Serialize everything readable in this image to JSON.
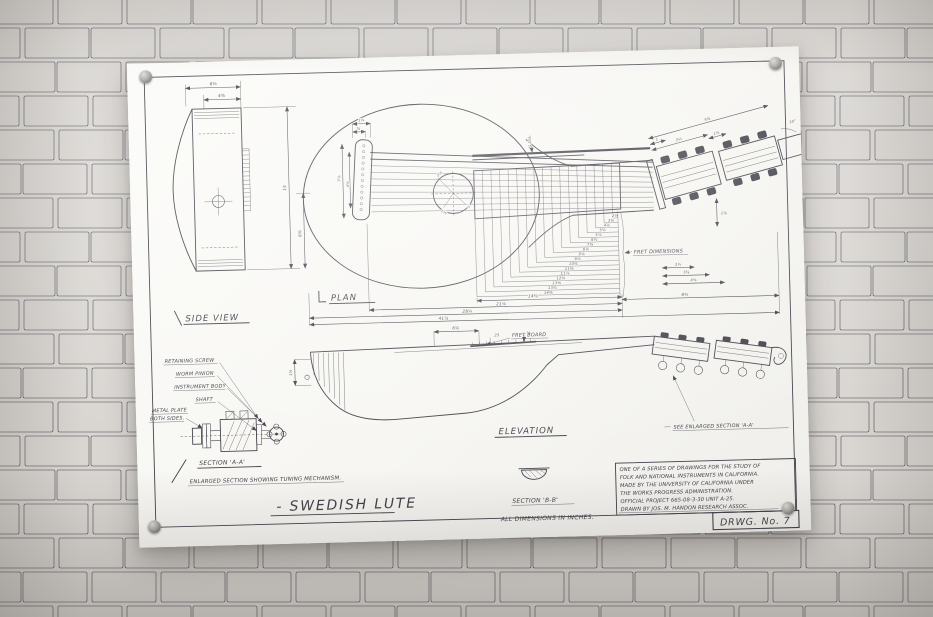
{
  "colors": {
    "ink": "#41414a",
    "paper": "#f7f6f2",
    "wall_mortar": "#d9d6d2",
    "brick_shades": [
      "#f1efeb",
      "#edebe7",
      "#f3f1ee",
      "#eae8e4",
      "#efede9"
    ]
  },
  "poster": {
    "title": "- SWEDISH  LUTE",
    "drawing_number": "DRWG. No. 7",
    "views": {
      "side": {
        "label": "SIDE VIEW",
        "dims": {
          "outer_width": "6½",
          "inner_width": "4⅜",
          "height": "15",
          "lower_height": "6⅜"
        }
      },
      "plan": {
        "label": "PLAN",
        "fret_note": "FRET DIMENSIONS",
        "fret_dims": [
          "14⅜",
          "13¾",
          "13⅜",
          "12⅝",
          "11⅞",
          "11⅜",
          "10⅝",
          "9⅞",
          "9⅛",
          "8⅛",
          "7⅜",
          "6¾",
          "5⅞",
          "5⅛",
          "4⅛",
          "3⅜",
          "2⅛"
        ],
        "overall_dims": [
          "14⅝",
          "21⅛",
          "28¼",
          "41⅞",
          "8¾"
        ],
        "head_dims": {
          "seg1": "1",
          "seg2": "2¼",
          "seg3": "1⅛",
          "total": "5⅜",
          "angle": "10°",
          "low1": "2½",
          "low2": "3⅝",
          "low3": "4⅛",
          "side": "1⅝"
        },
        "bridge_dims": {
          "outer": "7⅞",
          "inner": "4⅝",
          "top_small": "⅝",
          "top_wide": "1¼"
        },
        "soundhole_dims": {
          "d1": "2⅝",
          "d2": "1⅜",
          "d3": "⅞"
        },
        "neck_dia": "⅝ DIA."
      },
      "elevation": {
        "label": "ELEVATION",
        "fretboard_label": "FRET BOARD",
        "see_note": "SEE ENLARGED SECTION 'A-A'",
        "dims": {
          "overhang": "6⅛",
          "fret_height": ".25",
          "board_thickness": "⅛",
          "edge_depth": "1⅝"
        }
      },
      "section_aa": {
        "label": "SECTION 'A-A'",
        "caption": "ENLARGED SECTION SHOWING TUNING MECHANISM.",
        "parts": [
          "RETAINING SCREW",
          "WORM PINION",
          "INSTRUMENT BODY",
          "SHAFT",
          "METAL PLATE",
          "BOTH SIDES."
        ]
      },
      "section_bb": {
        "label": "SECTION 'B-B'",
        "units_note": "ALL DIMENSIONS IN INCHES."
      }
    },
    "notes": {
      "lines": [
        "ONE OF A SERIES OF DRAWINGS FOR THE STUDY OF",
        "FOLK AND NATIONAL INSTRUMENTS IN CALIFORNIA.",
        "MADE BY THE UNIVERSITY OF CALIFORNIA UNDER",
        "THE WORKS PROGRESS ADMINISTRATION.",
        "OFFICIAL PROJECT 665-08-3-30 UNIT A-25.",
        "DRAWN BY JOS. M. HANDON RESEARCH ASSOC."
      ]
    }
  }
}
